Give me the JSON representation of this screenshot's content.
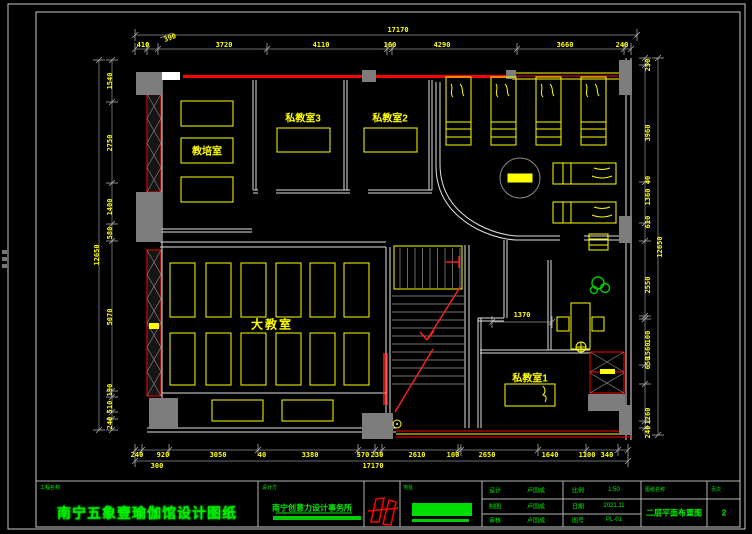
{
  "plan": {
    "rooms": {
      "training_room": "教培室",
      "private_room_3": "私教室3",
      "private_room_2": "私教室2",
      "big_classroom": "大教室",
      "private_room_1": "私教室1"
    },
    "dims": {
      "top_total": [
        "17170"
      ],
      "top": [
        "410",
        "390",
        "3720",
        "4110",
        "160",
        "4290",
        "3660",
        "240"
      ],
      "bottom": [
        "240",
        "920",
        "3050",
        "40",
        "3380",
        "570",
        "230",
        "2610",
        "100",
        "2650",
        "1640",
        "1100",
        "340"
      ],
      "bottom_extra": [
        "300",
        "17170"
      ],
      "left": [
        "1540",
        "2750",
        "1400",
        "580",
        "5070",
        "190",
        "510",
        "240"
      ],
      "left_total": [
        "12650"
      ],
      "right": [
        "250",
        "3960",
        "40",
        "1360",
        "610",
        "2550",
        "100",
        "1560",
        "650",
        "1260",
        "240"
      ],
      "right_total": [
        "12650"
      ],
      "room_dim": [
        "1370"
      ]
    }
  },
  "title_block": {
    "project_label": "工程名称",
    "project_name": "南宁五象壹瑜伽馆设计图纸",
    "designer_label": "设计方",
    "designer_name": "南宁创意力设计事务所",
    "address_label": "地址",
    "rows": [
      {
        "label": "设计",
        "value": "卢国成"
      },
      {
        "label": "制图",
        "value": "卢国成"
      },
      {
        "label": "审核",
        "value": "卢国成"
      }
    ],
    "meta": [
      {
        "label": "比例",
        "value": "1:50"
      },
      {
        "label": "日期",
        "value": "2021.11"
      },
      {
        "label": "图号",
        "value": "PL-01"
      }
    ],
    "sheet_name_label": "图纸名称",
    "sheet_name": "二层平面布置图",
    "page_label": "页次",
    "page": "2"
  },
  "colors": {
    "line_yellow": "#ffff00",
    "wall_white": "#e0e0e0",
    "accent_red": "#ff0000",
    "column_gray": "#7d7d7d",
    "text_green": "#00ee00"
  }
}
